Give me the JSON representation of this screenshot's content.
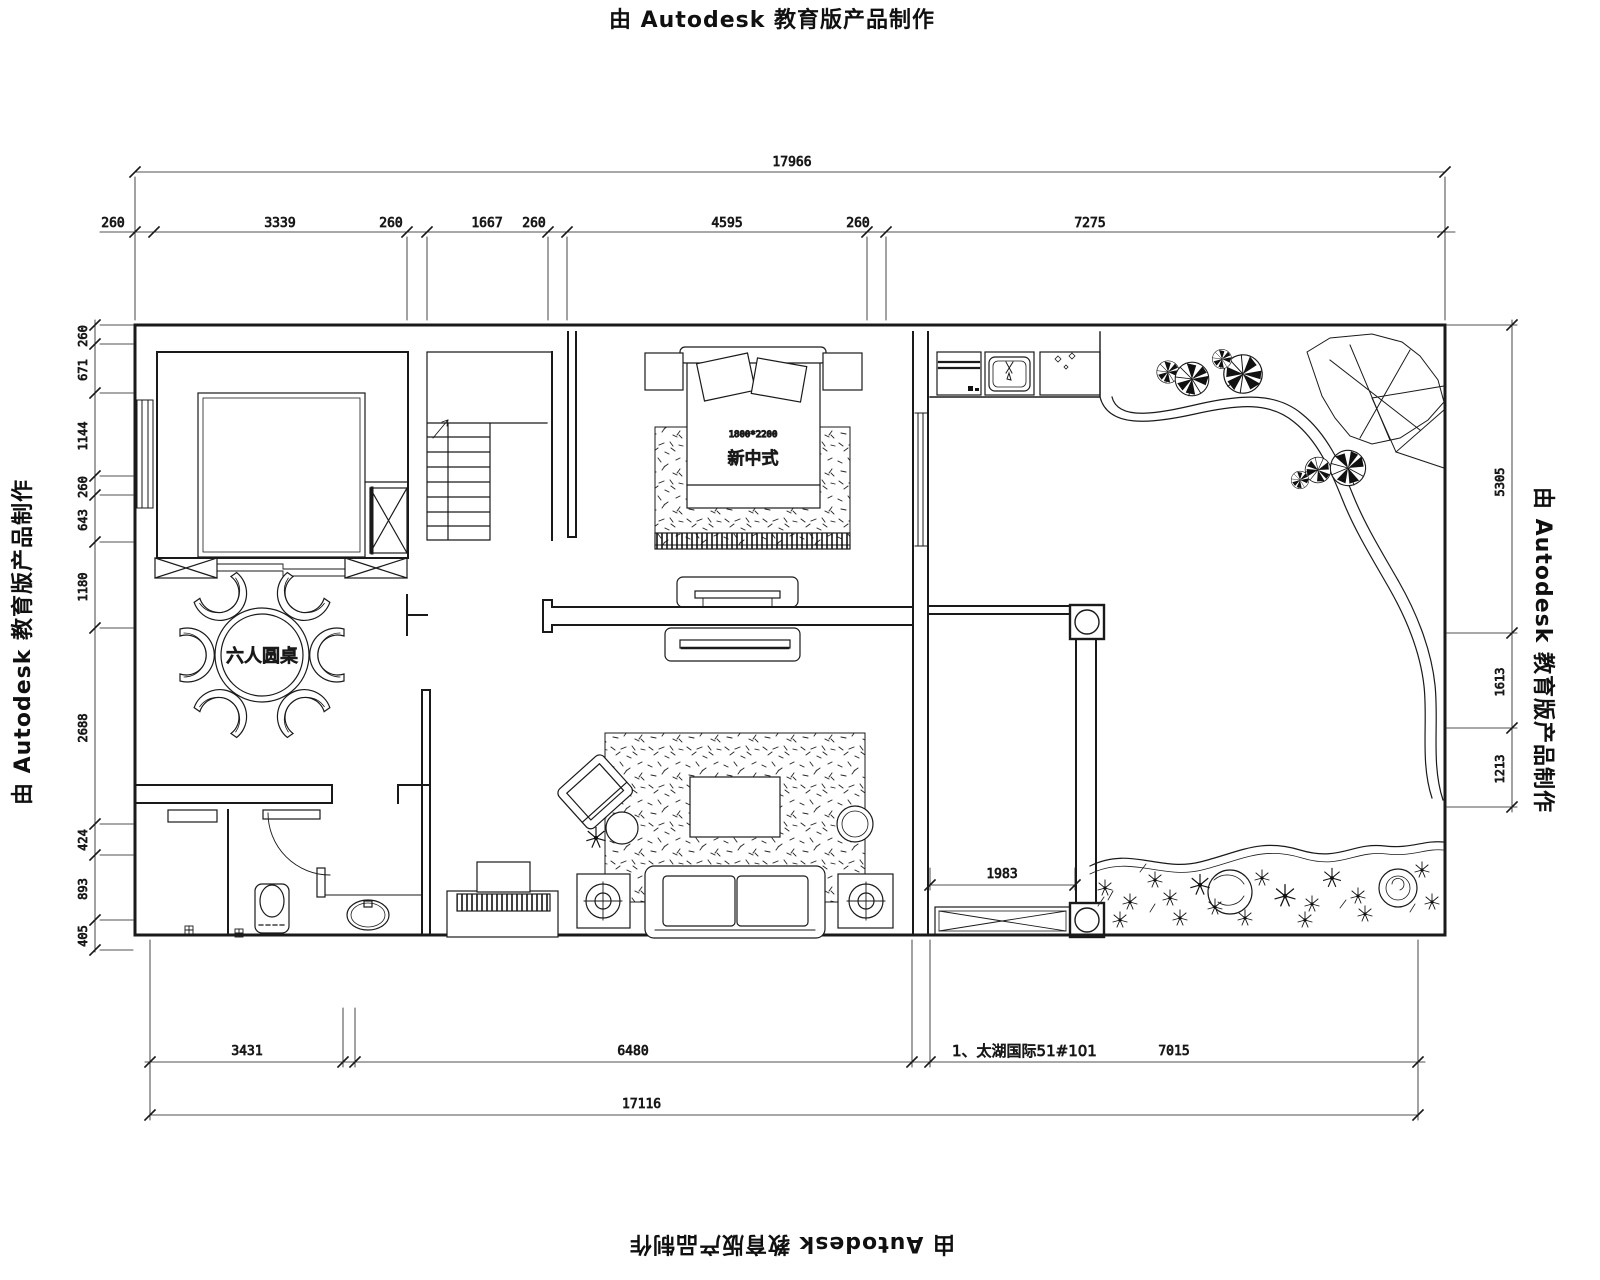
{
  "watermark": {
    "text": "由 Autodesk 教育版产品制作"
  },
  "dimensions": {
    "top_total": "17966",
    "top": [
      "260",
      "3339",
      "260",
      "1667",
      "260",
      "4595",
      "260",
      "7275"
    ],
    "left": [
      "260",
      "671",
      "1144",
      "260",
      "643",
      "1180",
      "2688",
      "424",
      "893",
      "405"
    ],
    "right": [
      "5305",
      "1613",
      "1213"
    ],
    "bottom": [
      "3431",
      "6480",
      "7015"
    ],
    "bottom_total": "17116",
    "bedroom2_width": "1983"
  },
  "labels": {
    "dining_table": "六人圆桌",
    "bed_style": "新中式",
    "bed_size": "1800*2200",
    "project": "1、太湖国际51#101"
  },
  "colors": {
    "line": "#1a1a1a",
    "background": "#ffffff"
  }
}
